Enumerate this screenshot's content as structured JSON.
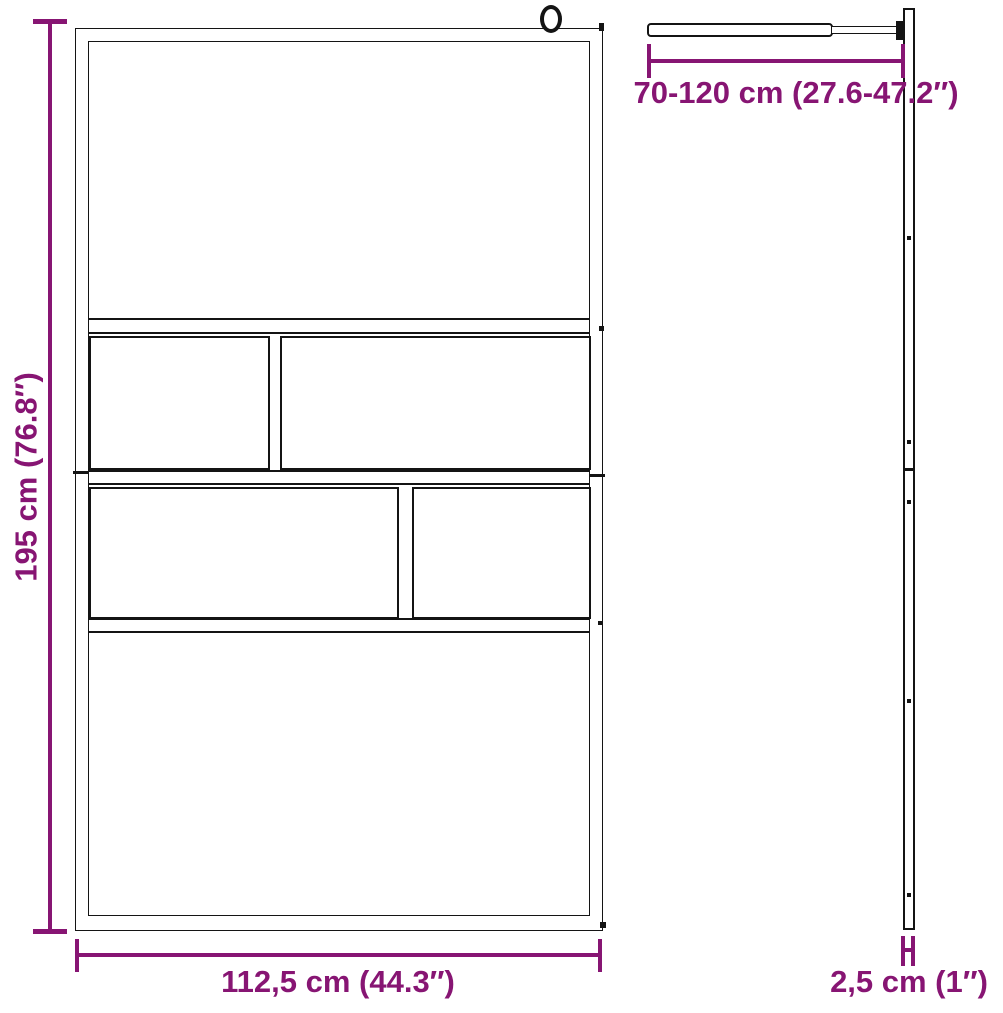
{
  "accent_color": "#871573",
  "line_color": "#141414",
  "dimensions": {
    "height": {
      "label": "195 cm (76.8″)"
    },
    "width": {
      "label": "112,5 cm (44.3″)"
    },
    "support_bar": {
      "label": "70-120 cm (27.6-47.2″)"
    },
    "thickness": {
      "label": "2,5 cm (1″)"
    }
  }
}
